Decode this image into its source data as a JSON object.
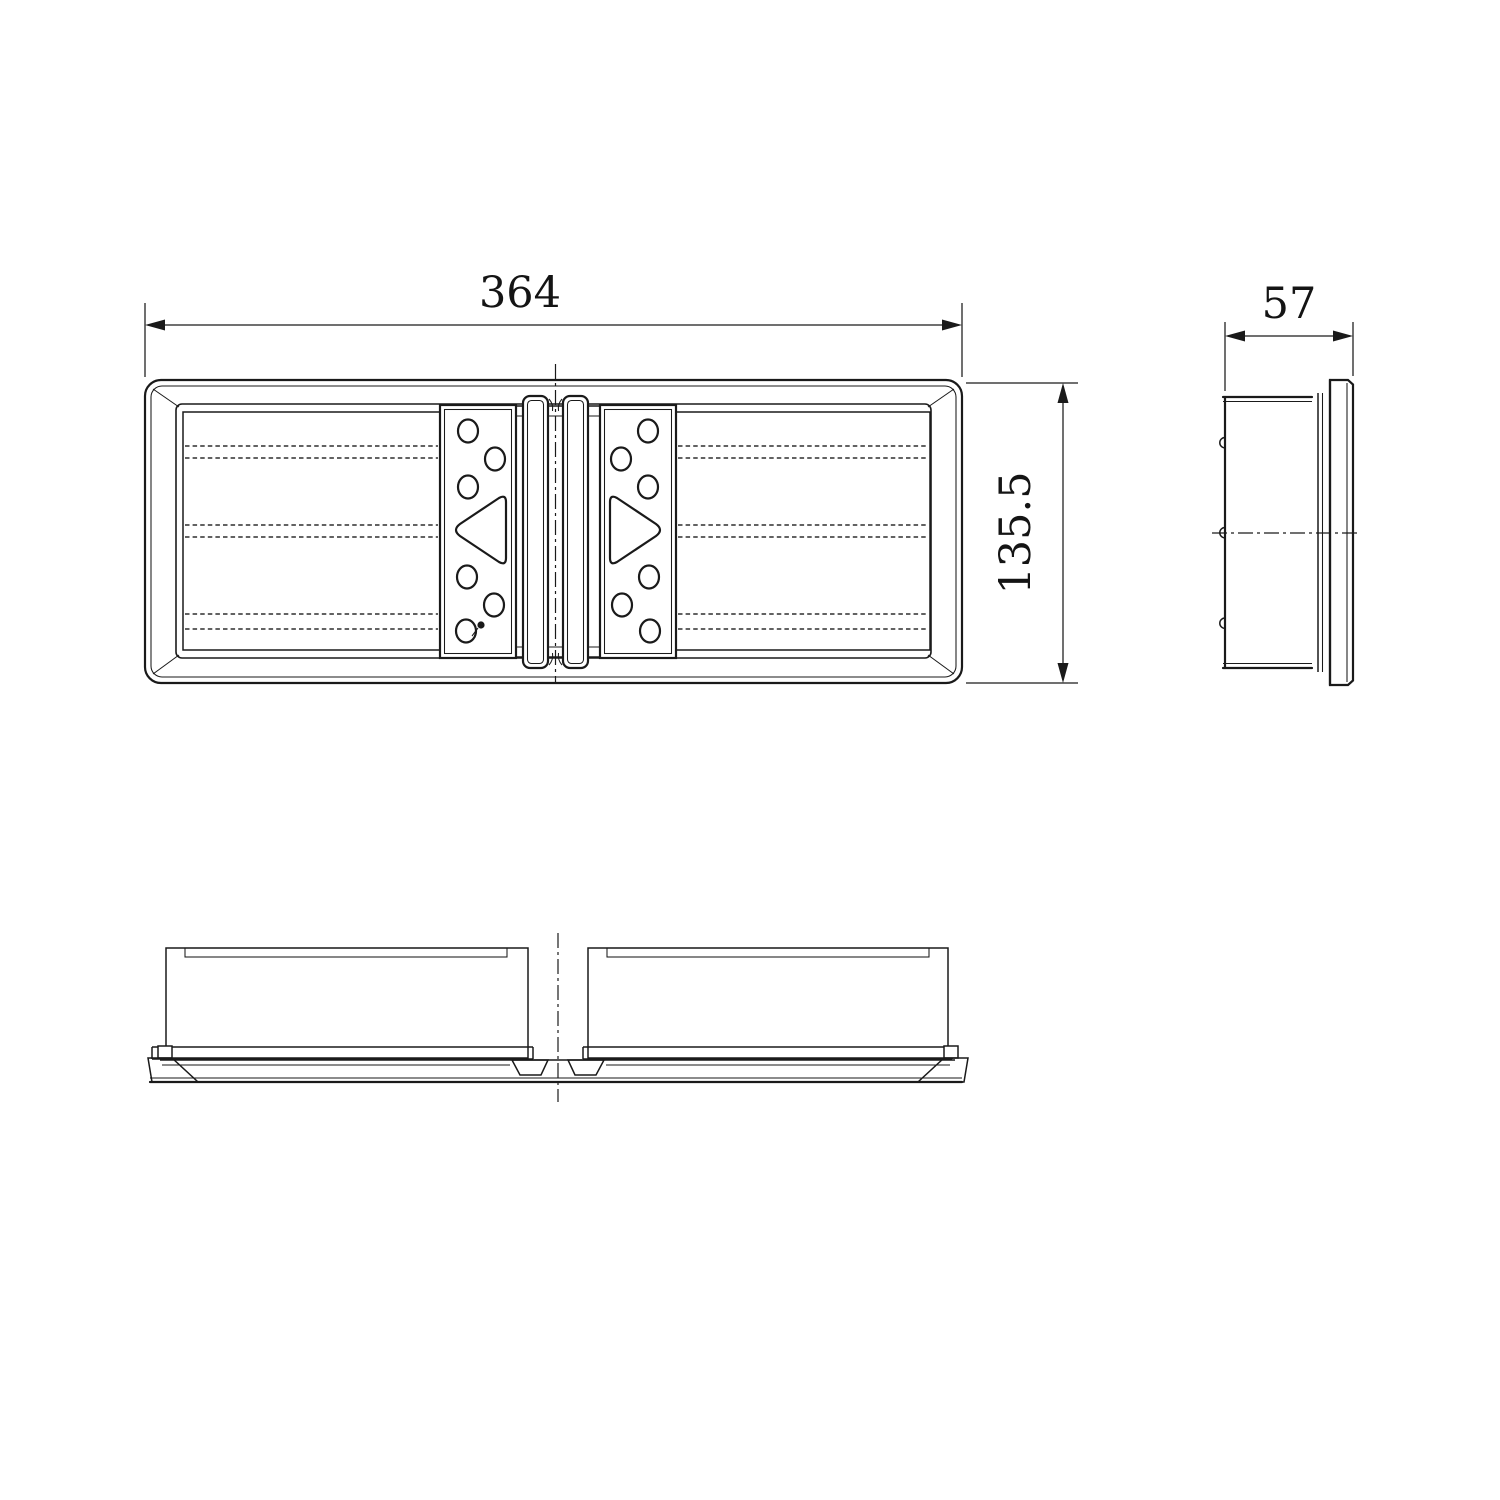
{
  "drawing": {
    "front_view": {
      "width_dim": "364",
      "height_dim": "135.5"
    },
    "side_view": {
      "depth_dim": "57"
    },
    "colors": {
      "line": "#1a1a1a",
      "background": "#ffffff"
    }
  }
}
